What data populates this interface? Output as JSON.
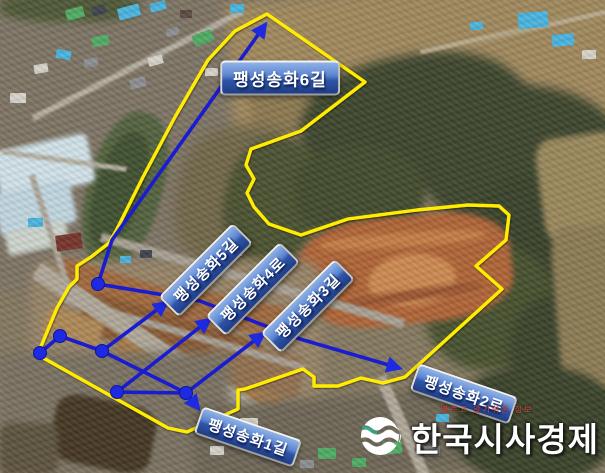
{
  "map": {
    "description": "annotated aerial photo of Paengseong Songhwa road district",
    "colors": {
      "boundary": "#ffec00",
      "road": "#1a1ccf",
      "marker": "#1d2ae0",
      "label_background_top": "#8fb2e8",
      "label_background_bottom": "#1f3d85",
      "label_text": "#ffffff",
      "slogan_text": "#d84338"
    },
    "labels": [
      {
        "id": "route-6",
        "text": "팽성송화6길",
        "cx": 280,
        "cy": 78,
        "rot": 0,
        "big": true
      },
      {
        "id": "route-5",
        "text": "팽성송화5길",
        "cx": 206,
        "cy": 270,
        "rot": -45,
        "big": false
      },
      {
        "id": "route-4",
        "text": "팽성송화4로",
        "cx": 253,
        "cy": 289,
        "rot": -45,
        "big": false
      },
      {
        "id": "route-3",
        "text": "팽성송화3길",
        "cx": 308,
        "cy": 306,
        "rot": -45,
        "big": false
      },
      {
        "id": "route-2",
        "text": "팽성송화2로",
        "cx": 464,
        "cy": 394,
        "rot": 19,
        "big": false
      },
      {
        "id": "route-1",
        "text": "팽성송화1길",
        "cx": 248,
        "cy": 437,
        "rot": 19,
        "big": false
      }
    ],
    "overlay": {
      "boundary": [
        [
          267,
          14
        ],
        [
          365,
          82
        ],
        [
          301,
          131
        ],
        [
          251,
          149
        ],
        [
          246,
          165
        ],
        [
          254,
          179
        ],
        [
          247,
          193
        ],
        [
          254,
          207
        ],
        [
          269,
          224
        ],
        [
          301,
          235
        ],
        [
          348,
          219
        ],
        [
          417,
          210
        ],
        [
          468,
          205
        ],
        [
          499,
          206
        ],
        [
          509,
          215
        ],
        [
          506,
          240
        ],
        [
          476,
          266
        ],
        [
          502,
          289
        ],
        [
          405,
          377
        ],
        [
          383,
          383
        ],
        [
          361,
          378
        ],
        [
          338,
          386
        ],
        [
          314,
          386
        ],
        [
          314,
          377
        ],
        [
          303,
          369
        ],
        [
          245,
          389
        ],
        [
          238,
          390
        ],
        [
          238,
          409
        ],
        [
          187,
          432
        ],
        [
          168,
          428
        ],
        [
          38,
          355
        ],
        [
          42,
          344
        ],
        [
          57,
          308
        ],
        [
          69,
          287
        ],
        [
          77,
          279
        ],
        [
          77,
          266
        ],
        [
          91,
          257
        ],
        [
          109,
          243
        ],
        [
          116,
          231
        ],
        [
          143,
          177
        ],
        [
          175,
          117
        ],
        [
          208,
          60
        ],
        [
          235,
          31
        ]
      ],
      "roads": [
        {
          "name": "route-6-road",
          "points": [
            [
              98,
              284
            ],
            [
              112,
              240
            ],
            [
              265,
              25
            ]
          ],
          "arrow": true
        },
        {
          "name": "route-2-road",
          "points": [
            [
              98,
              284
            ],
            [
              200,
              301
            ],
            [
              300,
              339
            ],
            [
              399,
              368
            ]
          ],
          "arrow": true
        },
        {
          "name": "route-5-road",
          "points": [
            [
              102,
              351
            ],
            [
              166,
              303
            ]
          ],
          "arrow": true
        },
        {
          "name": "route-4-road",
          "points": [
            [
              117,
              392
            ],
            [
              209,
              320
            ]
          ],
          "arrow": true
        },
        {
          "name": "route-3-road",
          "points": [
            [
              186,
              393
            ],
            [
              263,
              334
            ]
          ],
          "arrow": true
        },
        {
          "name": "route-1-road",
          "points": [
            [
              186,
              393
            ],
            [
              198,
              408
            ]
          ],
          "arrow": true
        },
        {
          "name": "west-link-road",
          "points": [
            [
              40,
              353
            ],
            [
              60,
              336
            ]
          ],
          "arrow": false
        },
        {
          "name": "middle-road",
          "points": [
            [
              60,
              336
            ],
            [
              102,
              351
            ],
            [
              186,
              393
            ]
          ],
          "arrow": false
        },
        {
          "name": "south-link-road",
          "points": [
            [
              117,
              392
            ],
            [
              186,
              393
            ]
          ],
          "arrow": false
        }
      ],
      "junctions": [
        [
          98,
          284
        ],
        [
          60,
          336
        ],
        [
          40,
          353
        ],
        [
          102,
          351
        ],
        [
          117,
          392
        ],
        [
          186,
          393
        ]
      ]
    }
  },
  "logo": {
    "name": "한국시사경제",
    "slogan": "빠르고 알기쉬운 정보"
  }
}
